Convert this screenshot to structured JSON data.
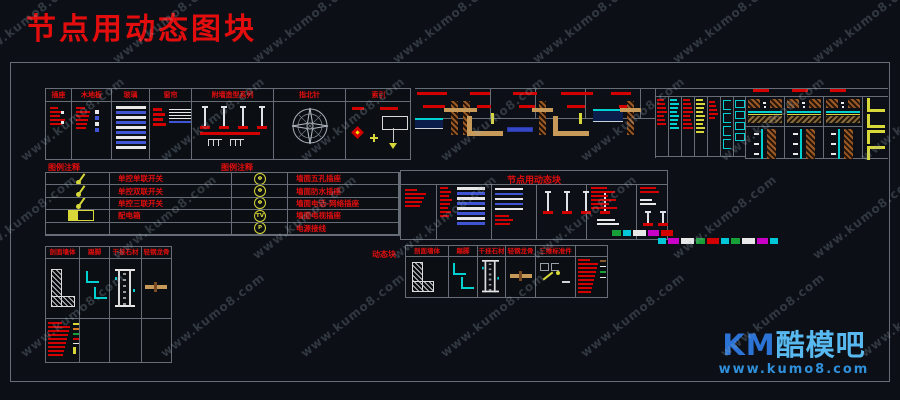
{
  "title": "节点用动态图块",
  "watermark": {
    "text": "www.kumo8.com"
  },
  "tables": {
    "materials": {
      "headers": [
        "插座",
        "木地板",
        "玻璃",
        "窗帘",
        "附墙造型系列",
        "指北针",
        "索引"
      ]
    },
    "legend": {
      "caption_left": "图例注释",
      "caption_right": "图例注释",
      "rows": [
        {
          "icon": "wall-lamp",
          "label": "单控单联开关",
          "symbol": "Φ",
          "label2": "墙面五孔插座"
        },
        {
          "icon": "wall-lamp",
          "label": "单控双联开关",
          "symbol": "Φ",
          "label2": "墙面防水插座"
        },
        {
          "icon": "wall-lamp",
          "label": "单控三联开关",
          "symbol": "Φ",
          "label2": "墙面电话-网络插座"
        },
        {
          "icon": "panel-box",
          "label": "配电箱",
          "symbol": "TV",
          "label2": "墙面电视插座"
        },
        {
          "icon": "",
          "label": "",
          "symbol": "P",
          "label2": "电源接线"
        }
      ]
    },
    "dynamic_blocks": {
      "title": "节点用动态块"
    },
    "bottom_left": {
      "headers": [
        "剖面墙体",
        "踢脚",
        "干挂石材",
        "轻钢龙骨"
      ]
    },
    "bottom_mid": {
      "side_label": "动态块",
      "headers": [
        "剖面墙体",
        "踢脚",
        "干挂石材",
        "轻钢龙骨",
        "三维标准件",
        ""
      ]
    }
  },
  "logo": {
    "brand_km": "KM",
    "brand_rest": "酷模吧",
    "url": "www.kumo8.com"
  },
  "colors": {
    "background": "#0c0f15",
    "grid_line": "#676d76",
    "cad_red": "#d40000",
    "cad_blue": "#4055d4",
    "cad_cyan": "#00d0d0",
    "cad_yellow": "#d8d83a",
    "cad_tan": "#c89a5a",
    "cad_brick": "#9a5a28",
    "cad_white": "#e8e8e8",
    "logo_blue": "#2b74d6",
    "logo_light_blue": "#58b9f0",
    "watermark_gray": "#9aa3b0"
  },
  "decor": {
    "swatch_strip1": [
      "#18a038",
      "#00c8d8",
      "#e8e8e8",
      "#c800c8",
      "#d40000"
    ],
    "swatch_strip2": [
      "#00c8d8",
      "#c800c8",
      "#e8e8e8",
      "#18a038",
      "#d40000",
      "#00c8d8",
      "#18a038",
      "#e8e8e8",
      "#c800c8",
      "#00c8d8"
    ]
  }
}
